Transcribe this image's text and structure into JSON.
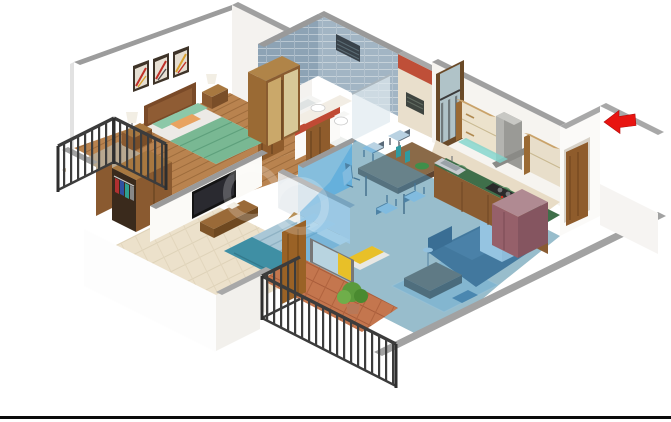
{
  "scene": {
    "type": "isometric-3d-floor-plan-render",
    "background": "#ffffff",
    "highlighted_area": "living-dining",
    "highlight_opacity": "0.45",
    "rooms": [
      {
        "id": "master-bedroom",
        "floor": "wood"
      },
      {
        "id": "bedroom-2",
        "floor": "cream-tile"
      },
      {
        "id": "bathroom-1",
        "walls": "blue-grey-tile"
      },
      {
        "id": "bathroom-2",
        "walls": "cream-red-tile"
      },
      {
        "id": "kitchen",
        "counter": "green-marble"
      },
      {
        "id": "living-dining",
        "highlighted": true
      },
      {
        "id": "balcony-left"
      },
      {
        "id": "balcony-bottom",
        "floor": "terracotta"
      },
      {
        "id": "kitchen-utility-balcony"
      },
      {
        "id": "entrance-lobby"
      }
    ],
    "entrance_arrow": {
      "glyph": "block-arrow-left",
      "color": "#e81410"
    },
    "footer_rule_color": "#0a0a0a"
  },
  "palette": {
    "wall_white": "#ffffff",
    "wall_shade": "#f4f2ef",
    "cap_grey": "#9c9c9c",
    "highlight_blue": "#3da0dc",
    "arrow_red": "#e81410",
    "wood_floor": "#b9834f",
    "tile_blue": "#8da3b5",
    "tile_blue_light": "#a2b5c4",
    "accent_red_tile": "#bf4f38",
    "bed_green": "#79b893",
    "bed_teal": "#3f8fa4",
    "bed_blue_light": "#a9c7d6",
    "sofa_slate": "#46586c",
    "pillow_lime": "#a9c23c",
    "counter_green": "#3f6f4a",
    "cabinet_wood": "#8a5c32",
    "cabinet_cream": "#ece2cc",
    "fridge_maroon": "#96606a",
    "terracotta": "#c4764e",
    "railing_dark": "#3c3c3c",
    "plant_green": "#5a9a3c",
    "curtain_yellow": "#e8c028",
    "door_wood": "#8f5c2c",
    "partition_blue": "#85bedd",
    "floor_beige": "#e2d6c0",
    "rule_black": "#0a0a0a"
  }
}
